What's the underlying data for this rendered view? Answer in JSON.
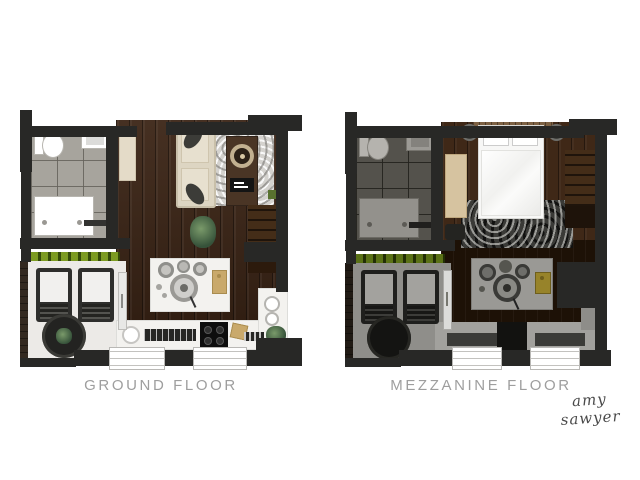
{
  "sheet": {
    "background": "#ffffff",
    "type": "floor-plan-rendering"
  },
  "plans": {
    "ground": {
      "label": "GROUND FLOOR",
      "rooms": [
        "bathroom",
        "living area",
        "kitchen",
        "balcony"
      ],
      "furniture": [
        "toilet",
        "wash basin",
        "shower",
        "tall cabinet",
        "sofa with cushions",
        "rug",
        "media console with speaker",
        "stairs",
        "kitchen island with stools",
        "cutting board",
        "kitchen sink",
        "drainer",
        "stove",
        "plates",
        "plants",
        "two balcony chairs",
        "round balcony table",
        "hedge planter",
        "sliding door",
        "two windows"
      ]
    },
    "mezzanine": {
      "label": "MEZZANINE FLOOR",
      "rooms": [
        "bathroom (below, shaded)",
        "bedroom",
        "open void with walkway",
        "balcony (below, shaded)"
      ],
      "furniture": [
        "double bed with pillows",
        "headboard",
        "two bedside lamps",
        "bench",
        "dark rug",
        "stairs",
        "kitchen island seen below",
        "walkway",
        "balcony chairs seen below",
        "round table seen below",
        "sliding door",
        "two windows"
      ]
    }
  },
  "signature": "amy sawyer",
  "colors": {
    "wall": "#282826",
    "wood": "#3a2314",
    "wood-mezz": "#3f2817",
    "wood-void": "#1d1106",
    "tile": "#a7a49d",
    "tile-dim": "#54524c",
    "balcony": "#eceae7",
    "balcony-dim": "#8f8e8a",
    "hedge": "#7c9b22",
    "hedge-dim": "#5a7116",
    "counter": "#f3f2ef",
    "label": "#9e9e9e",
    "signature-color": "#4a4a4a"
  }
}
